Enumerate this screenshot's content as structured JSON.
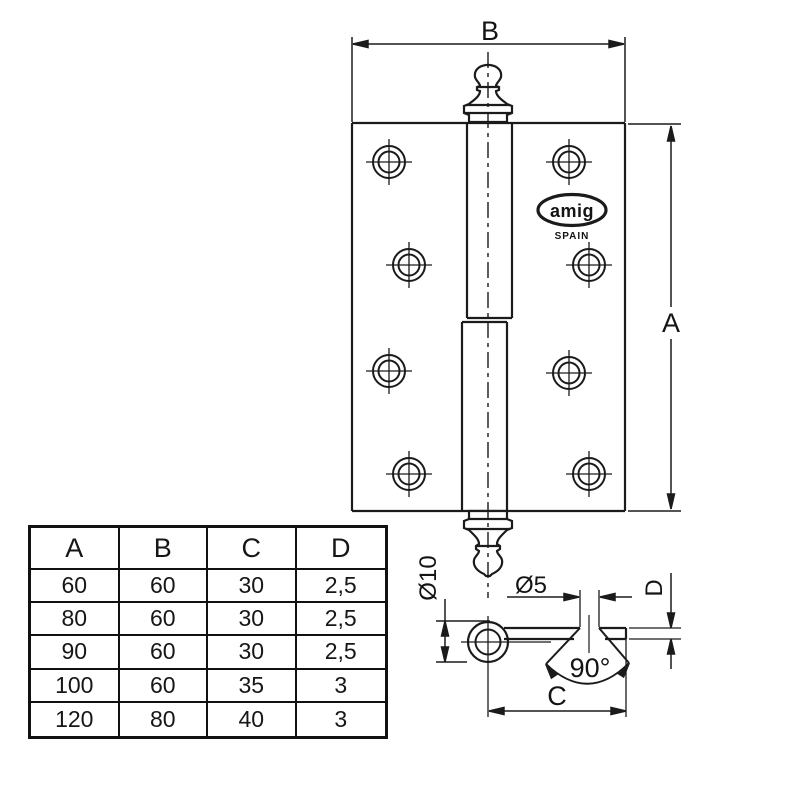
{
  "drawing": {
    "front_view": {
      "label_width": "B",
      "label_height": "A"
    },
    "bottom_view": {
      "label_pin_diameter": "Ø10",
      "label_hole_diameter": "Ø5",
      "label_thickness": "D",
      "label_leaf_width": "C",
      "label_countersink_angle": "90°"
    },
    "logo": {
      "brand": "amig",
      "country": "SPAIN"
    }
  },
  "table": {
    "headers": [
      "A",
      "B",
      "C",
      "D"
    ],
    "rows": [
      [
        "60",
        "60",
        "30",
        "2,5"
      ],
      [
        "80",
        "60",
        "30",
        "2,5"
      ],
      [
        "90",
        "60",
        "30",
        "2,5"
      ],
      [
        "100",
        "60",
        "35",
        "3"
      ],
      [
        "120",
        "80",
        "40",
        "3"
      ]
    ]
  }
}
